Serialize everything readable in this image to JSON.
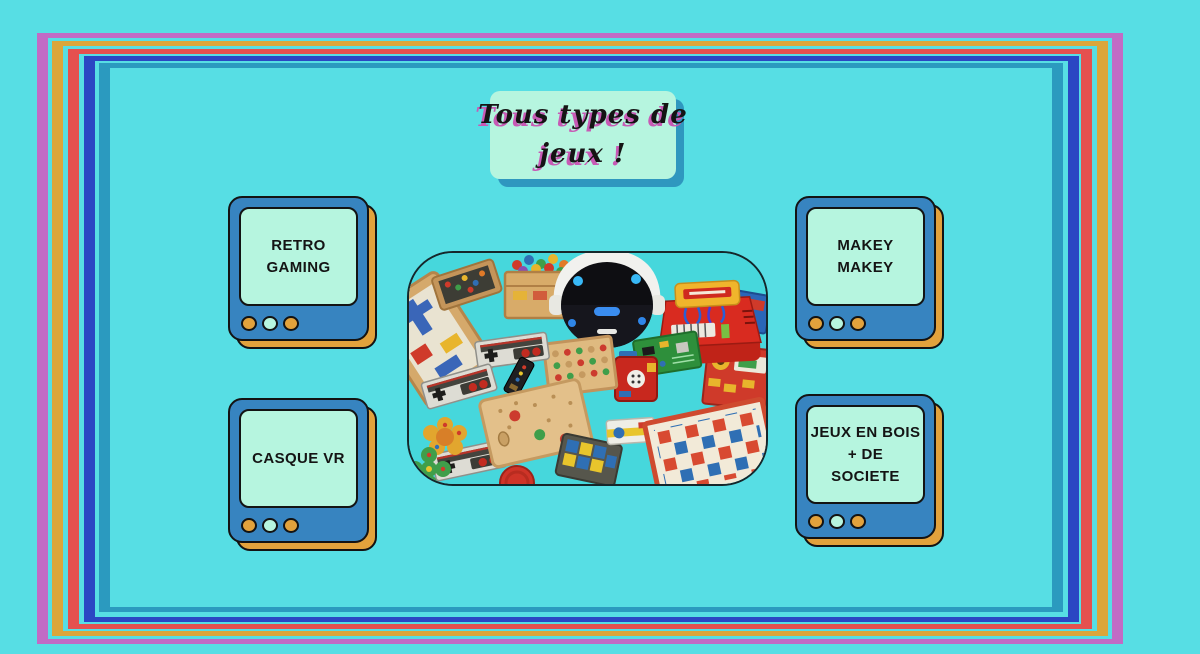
{
  "title": {
    "line1": "Tous types de",
    "line2": "jeux !"
  },
  "tvs": [
    {
      "id": "retro-gaming",
      "lines": [
        "RETRO",
        "GAMING"
      ]
    },
    {
      "id": "makey-makey",
      "lines": [
        "MAKEY",
        "MAKEY"
      ]
    },
    {
      "id": "casque-vr",
      "lines": [
        "CASQUE VR"
      ]
    },
    {
      "id": "jeux-en-bois",
      "lines": [
        "JEUX EN BOIS",
        "+ DE",
        "SOCIETE"
      ]
    }
  ],
  "photo": {
    "items": [
      "vr-headset",
      "nes-controllers",
      "wooden-peg-boards",
      "checkerboard-game",
      "electronics-kit",
      "building-blocks-crate",
      "circuit-boards",
      "puzzle-pieces",
      "game-boxes"
    ]
  },
  "theme": {
    "background": "#57dee4",
    "frame_purple": "#c16bc5",
    "frame_yellow": "#dca63b",
    "frame_red": "#e5514f",
    "frame_blue": "#2b47c3",
    "frame_teal": "#2b9abf",
    "mint": "#b6f5df",
    "tv_blue": "#3784c0",
    "tv_orange": "#e2a23c",
    "outline_black": "#131313",
    "box_shadow_teal": "#2f97bf",
    "title_shadow_pink": "#c75ab5",
    "text_black": "#141414"
  }
}
